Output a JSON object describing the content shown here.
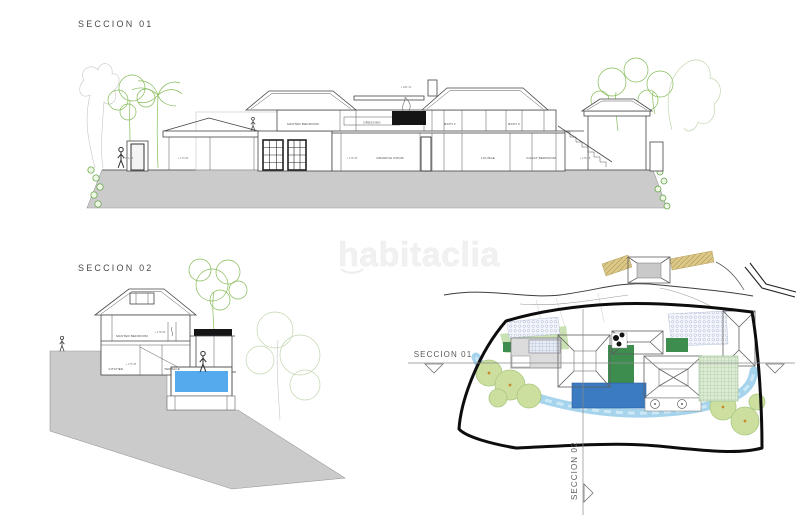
{
  "drawing": {
    "section01": {
      "title": "SECCION 01",
      "rooms": {
        "master_bedroom": "MASTER BEDROOM",
        "dressing": "DRESSING",
        "bath_2": "BATH 2",
        "bath_3": "BATH 3",
        "drawing_room": "DRAWING ROOM",
        "lounge": "LOUNGE",
        "guest_bedroom": "GUEST BEDROOM"
      },
      "levels": {
        "left_a": "+ 174.05",
        "left_b": "+ 174.05",
        "main": "+ 175.35",
        "right": "+ 175.35",
        "ridge": "+ 181.10"
      }
    },
    "section02": {
      "title": "SECCION 02",
      "rooms": {
        "master_bedroom": "MASTER BEDROOM",
        "kitchen": "KITCHEN",
        "terrace": "TERRACE"
      },
      "levels": {
        "upper": "+ 178.30",
        "lower": "+ 175.35"
      }
    },
    "site_plan": {
      "section01_label": "SECCION 01",
      "section02_label": "SECCION 02"
    },
    "watermark": "habitaclia",
    "colors": {
      "ground": "#cbcbcb",
      "pool_section": "#54aaec",
      "pool_plan": "#3b7bc1",
      "roof_gray": "#9c9c9c",
      "stream_blue": "#a6d4ec",
      "lawn_green": "#3d8d4f",
      "tree_green": "#ccdf9f",
      "driveway_tan": "#dcc98a",
      "line_dark": "#3c3c3c",
      "foliage_line": "#85bb58",
      "watermark_gray": "#f1f1f1"
    }
  }
}
